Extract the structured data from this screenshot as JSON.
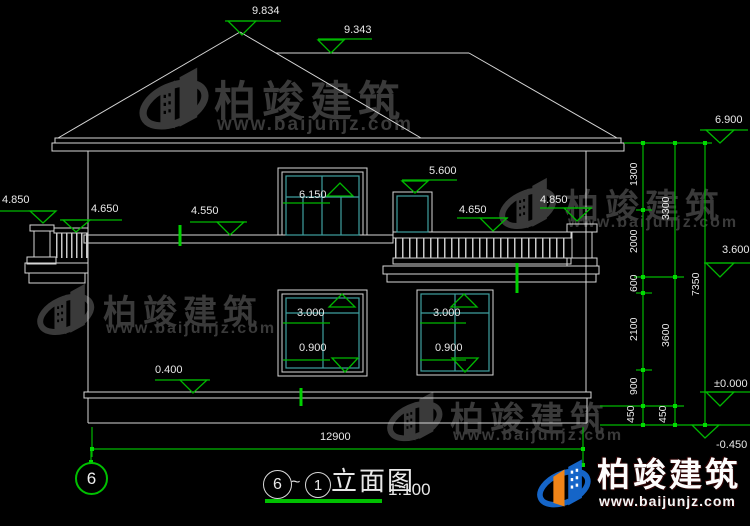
{
  "brand": {
    "name": "柏竣建筑",
    "site": "www.baijunjz.com"
  },
  "title_block": {
    "axis_from": "6",
    "separator": "~",
    "axis_to": "1",
    "drawing_name": "立面图",
    "scale": "1:100"
  },
  "axis_bubble": {
    "label": "6"
  },
  "levels": {
    "peak": "9.834",
    "ridge": "9.343",
    "eave": "6.900",
    "balcony_door_top": "6.150",
    "small_window_top": "5.600",
    "left_newel": "4.850",
    "left_rail": "4.650",
    "parapet": "4.550",
    "right_rail": "4.650",
    "right_newel": "4.850",
    "second_floor": "3.600",
    "window_top": "3.000",
    "window_sill": "0.900",
    "plinth": "0.400",
    "zero": "±0.000",
    "grade": "-0.450"
  },
  "dimensions": {
    "total_width": "12900",
    "inner_chain": [
      "1300",
      "2000",
      "600",
      "2100",
      "900",
      "450"
    ],
    "middle_chain": [
      "3300",
      "3600",
      "450"
    ],
    "outer_chain": [
      "7350"
    ]
  },
  "colors": {
    "background": "#000000",
    "line": "#d6d6d6",
    "accent_green": "#00b800",
    "window_cyan": "#3f9f9f",
    "watermark_gray": "#3a3a3a",
    "logo_blue": "#1565c8",
    "logo_orange": "#f08418"
  }
}
